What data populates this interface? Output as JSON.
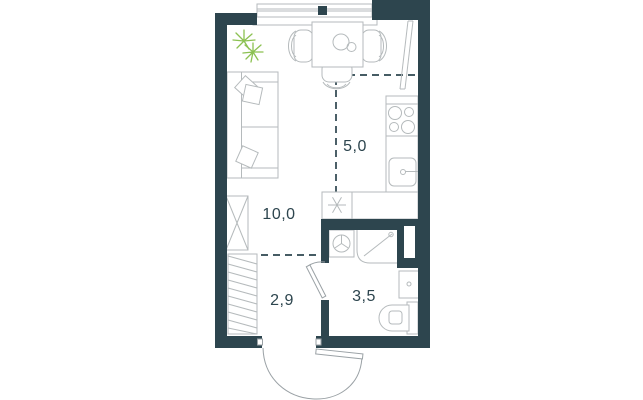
{
  "plan": {
    "type": "studio-apartment-floor-plan",
    "rooms": {
      "living": {
        "area_label": "10,0"
      },
      "kitchen": {
        "area_label": "5,0"
      },
      "hallway": {
        "area_label": "2,9"
      },
      "bathroom": {
        "area_label": "3,5"
      }
    },
    "fixtures": [
      "window",
      "window-handle",
      "plant",
      "sofa",
      "sofa-pillows",
      "wardrobe",
      "sliding-closet",
      "dining-table",
      "chair-left",
      "chair-right",
      "chair-bottom",
      "tall-cabinet",
      "stove",
      "kitchen-counter",
      "kitchen-sink",
      "fridge-snowflake-icon",
      "washing-machine",
      "shower-cabin",
      "ventilation-shaft",
      "washbasin",
      "toilet",
      "bathroom-door",
      "entrance-door"
    ]
  },
  "colors": {
    "wall": "#2d454e",
    "furniture_line": "#b5babc",
    "door_line": "#9aa1a5",
    "plant": "#8cc152",
    "background": "#ffffff"
  }
}
